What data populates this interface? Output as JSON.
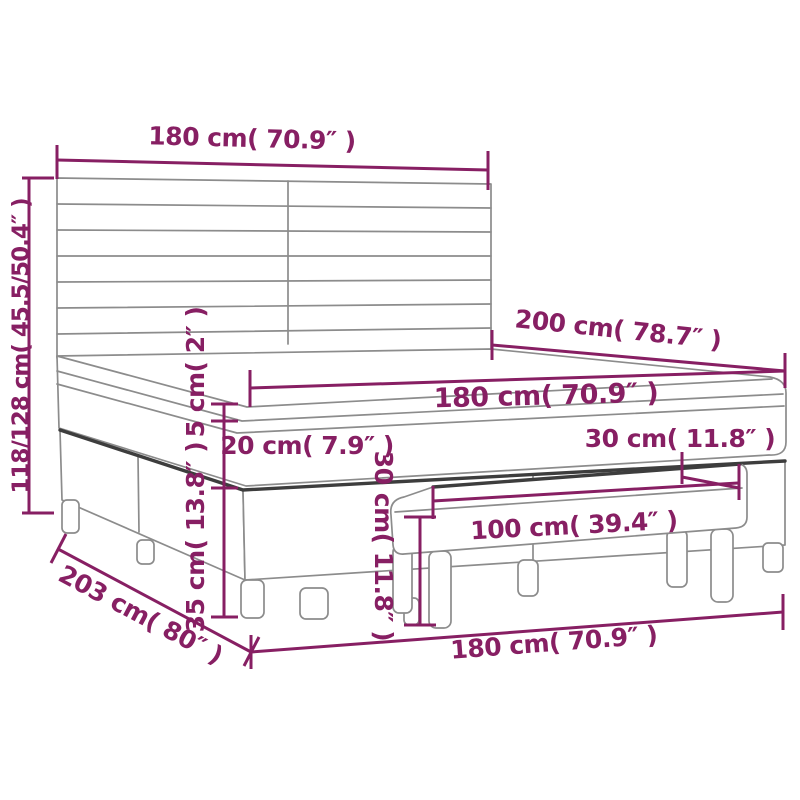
{
  "title": "Box spring bed with headboard and bench - dimension diagram",
  "colors": {
    "dimension_accent": "#871f63",
    "outline_light": "#8c8c8c",
    "outline_dark": "#3d3d3d",
    "background": "#ffffff"
  },
  "dimensions": {
    "headboard_width": {
      "text": "180 cm( 70.9″ )"
    },
    "bed_height": {
      "text": "118/128 cm( 45.5/50.4″ )"
    },
    "bed_length": {
      "text": "200 cm( 78.7″ )"
    },
    "mattress_width": {
      "text": "180 cm( 70.9″ )"
    },
    "topper_height": {
      "text": "5 cm( 2″ )"
    },
    "mattress_height": {
      "text": "20 cm( 7.9″ )"
    },
    "bench_depth": {
      "text": "30 cm( 11.8″ )"
    },
    "box_spring_height": {
      "text": "35 cm( 13.8″ )"
    },
    "bench_height": {
      "text": "30 cm( 11.8″ )"
    },
    "bench_length": {
      "text": "100 cm( 39.4″ )"
    },
    "bed_total_length": {
      "text": "203 cm( 80″ )"
    },
    "bed_width_bottom": {
      "text": "180 cm( 70.9″ )"
    }
  }
}
